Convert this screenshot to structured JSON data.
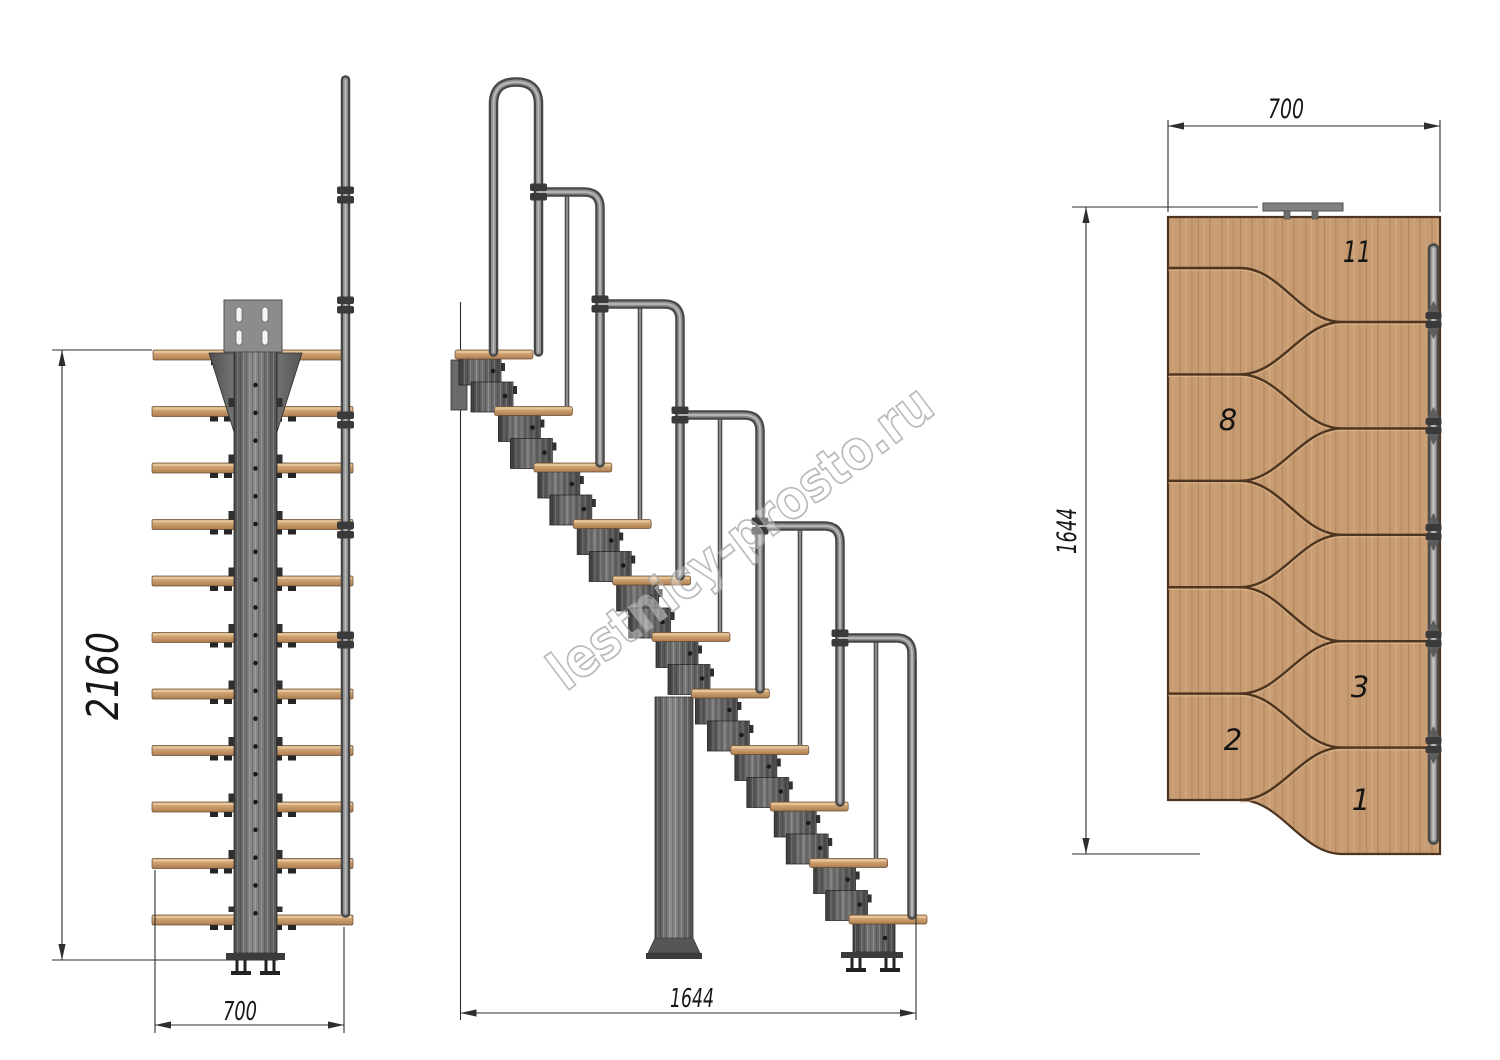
{
  "watermark": {
    "text": "lestnicy-prosto.ru"
  },
  "views": {
    "front": {
      "height_mm": "2160",
      "width_mm": "700"
    },
    "side": {
      "length_mm": "1644"
    },
    "plan": {
      "width_mm": "700",
      "length_mm": "1644",
      "tread_numbers": {
        "n11": "11",
        "n8": "8",
        "n3": "3",
        "n2": "2",
        "n1": "1"
      }
    }
  },
  "colors": {
    "background": "#ffffff",
    "wood": "#c89c72",
    "wood_edge": "#4d3520",
    "metal": "#6e6e6e",
    "dimension_lines": "#2e2e2e",
    "watermark": "#a9a9a9"
  }
}
